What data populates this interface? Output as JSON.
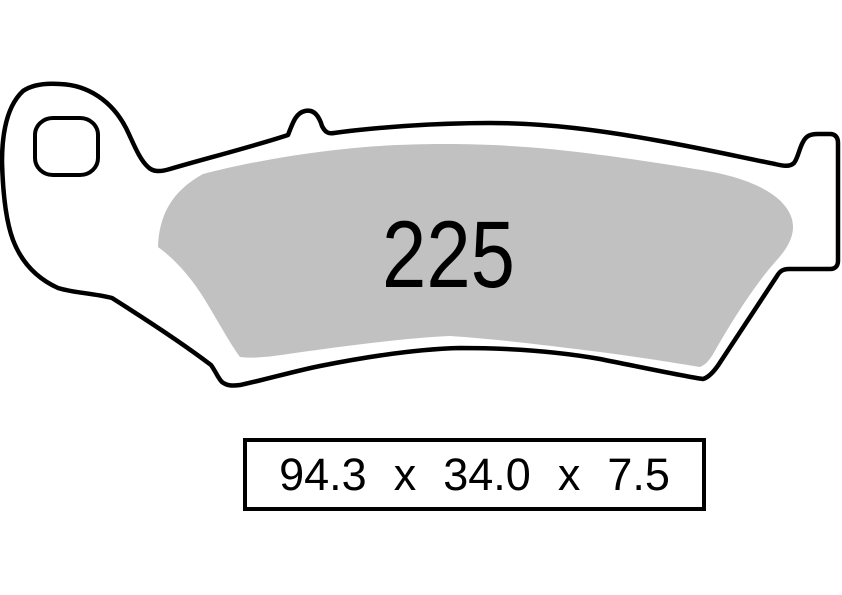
{
  "pad": {
    "part_number": "225",
    "dimensions": {
      "length": "94.3",
      "sep1": "x",
      "width": "34.0",
      "sep2": "x",
      "thickness": "7.5"
    }
  },
  "colors": {
    "outline": "#000000",
    "friction_material": "#c1c1c1",
    "background": "#ffffff"
  }
}
